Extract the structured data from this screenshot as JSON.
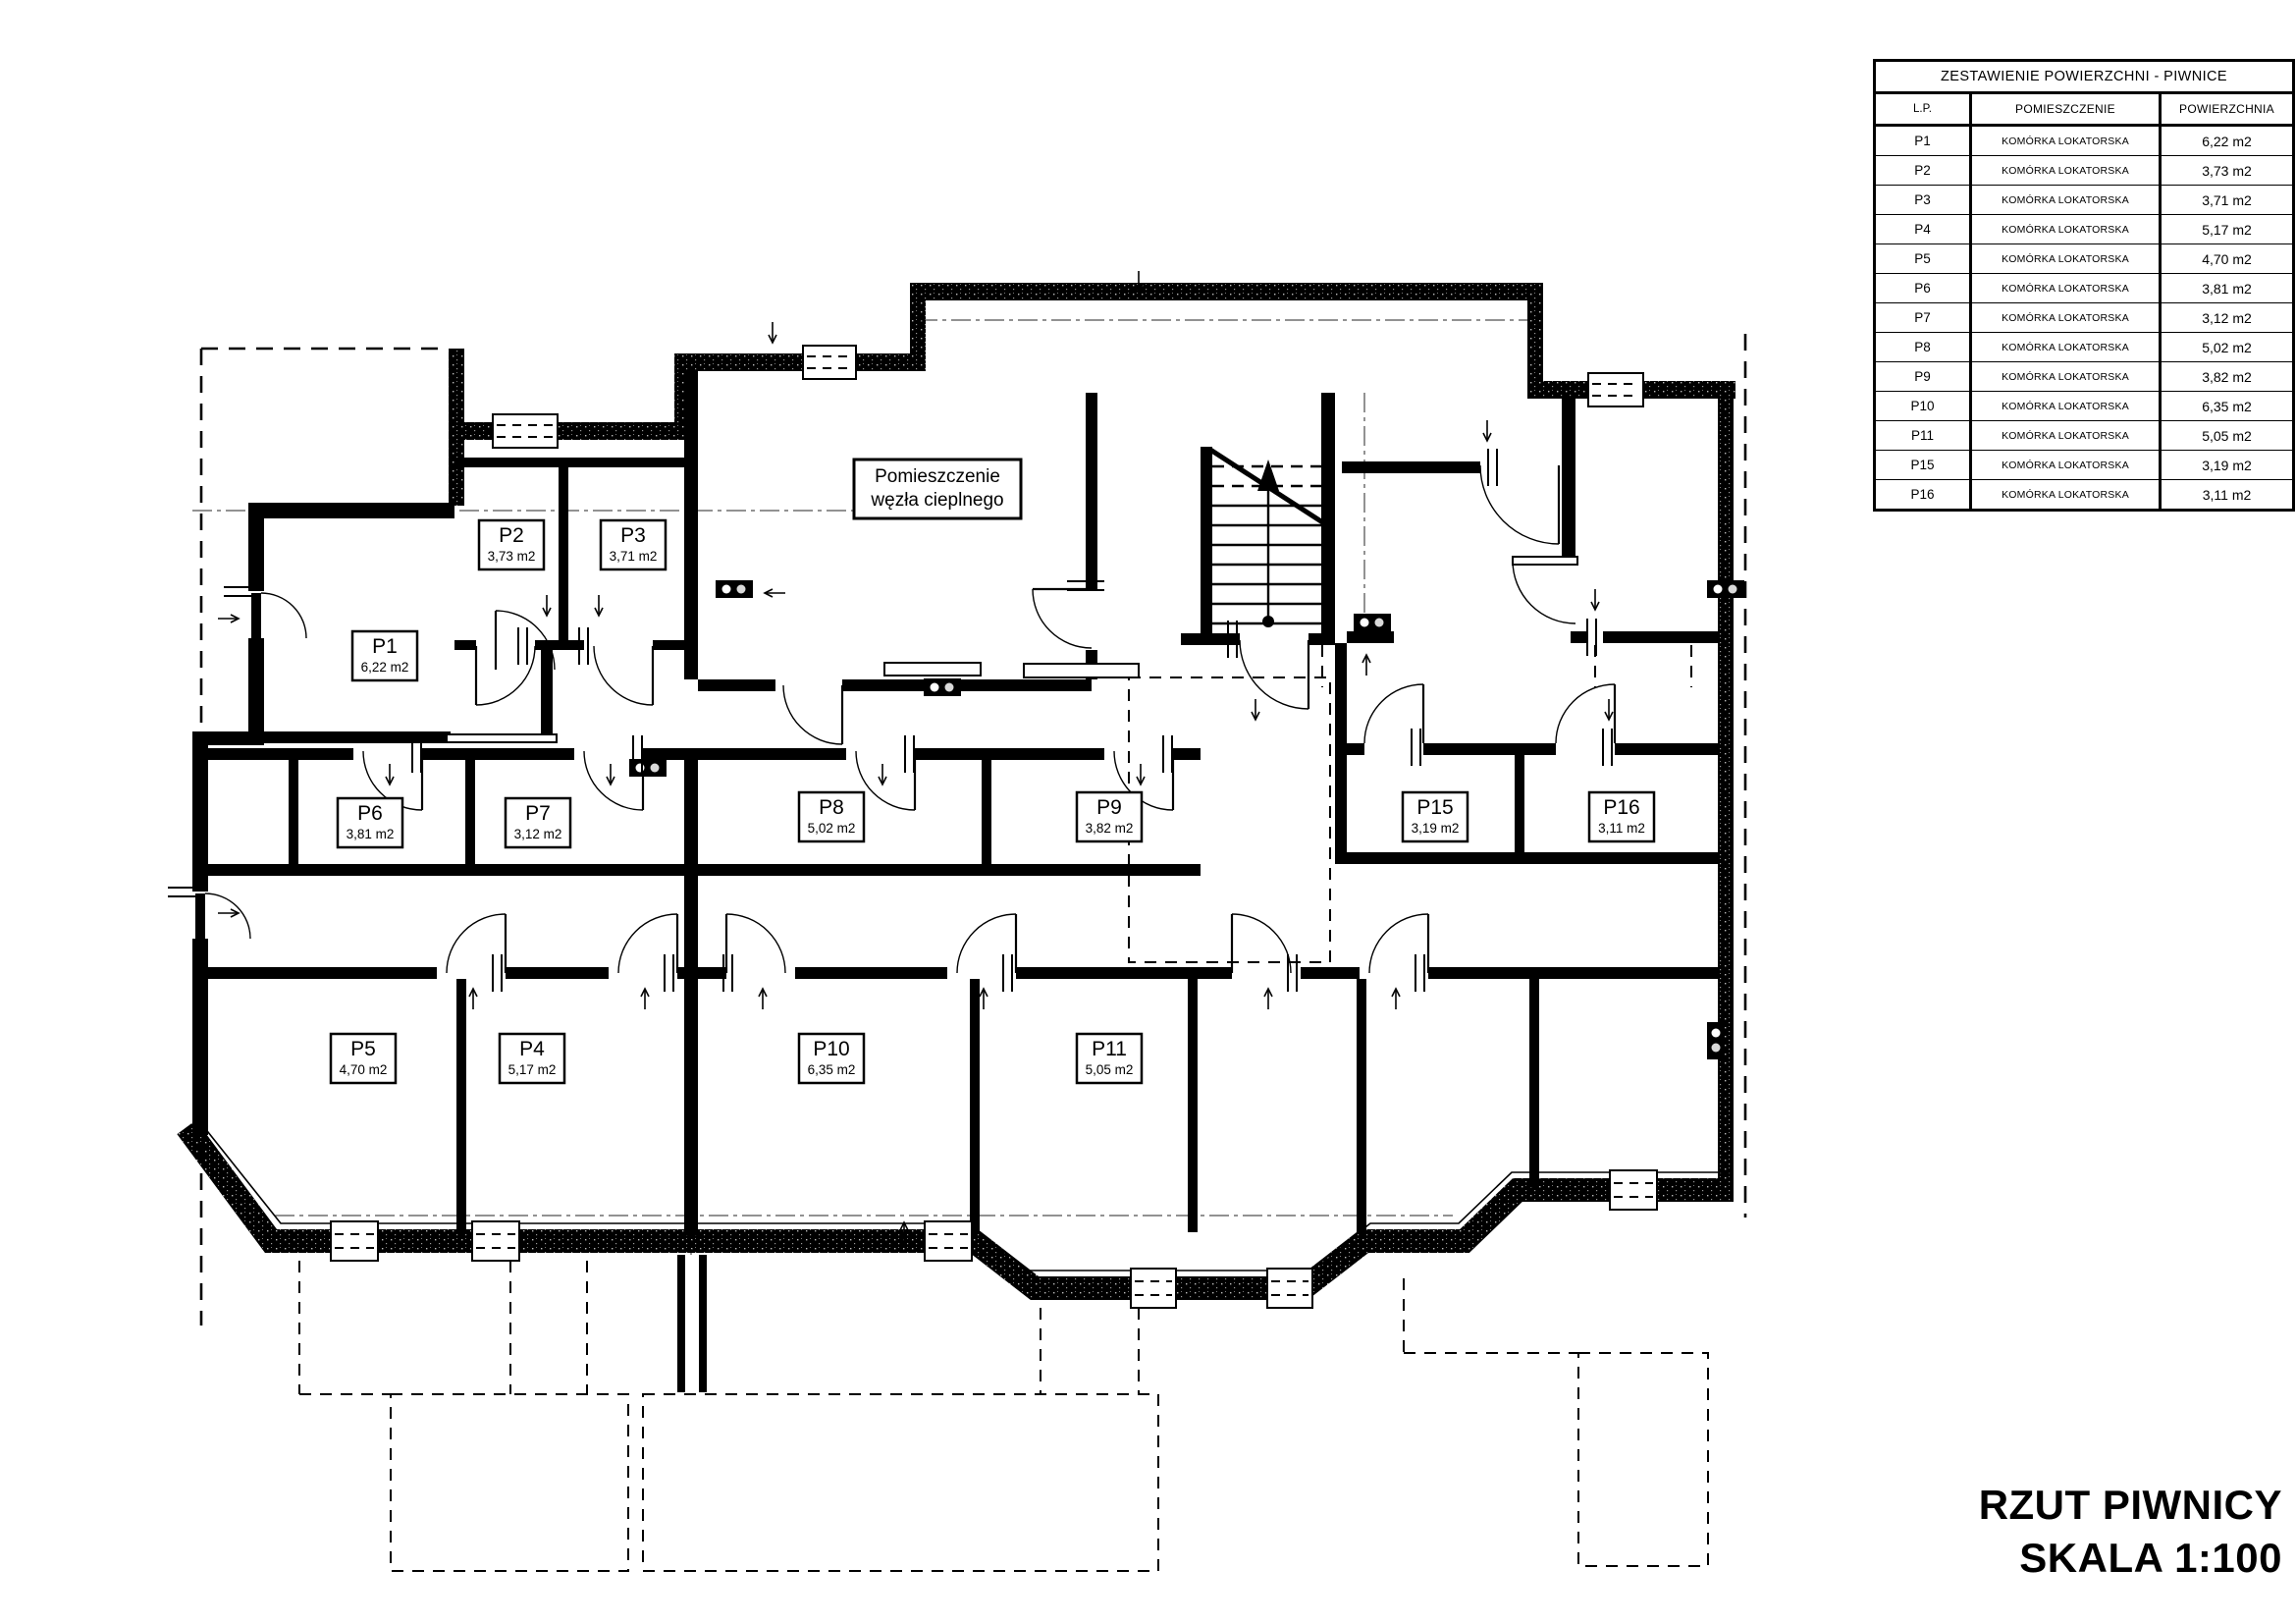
{
  "table": {
    "title": "ZESTAWIENIE POWIERZCHNI - PIWNICE",
    "columns": [
      "L.P.",
      "POMIESZCZENIE",
      "POWIERZCHNIA"
    ],
    "rows": [
      {
        "lp": "P1",
        "room": "KOMÓRKA LOKATORSKA",
        "area": "6,22 m2"
      },
      {
        "lp": "P2",
        "room": "KOMÓRKA LOKATORSKA",
        "area": "3,73 m2"
      },
      {
        "lp": "P3",
        "room": "KOMÓRKA LOKATORSKA",
        "area": "3,71 m2"
      },
      {
        "lp": "P4",
        "room": "KOMÓRKA LOKATORSKA",
        "area": "5,17 m2"
      },
      {
        "lp": "P5",
        "room": "KOMÓRKA LOKATORSKA",
        "area": "4,70 m2"
      },
      {
        "lp": "P6",
        "room": "KOMÓRKA LOKATORSKA",
        "area": "3,81 m2"
      },
      {
        "lp": "P7",
        "room": "KOMÓRKA LOKATORSKA",
        "area": "3,12 m2"
      },
      {
        "lp": "P8",
        "room": "KOMÓRKA LOKATORSKA",
        "area": "5,02 m2"
      },
      {
        "lp": "P9",
        "room": "KOMÓRKA LOKATORSKA",
        "area": "3,82 m2"
      },
      {
        "lp": "P10",
        "room": "KOMÓRKA LOKATORSKA",
        "area": "6,35 m2"
      },
      {
        "lp": "P11",
        "room": "KOMÓRKA LOKATORSKA",
        "area": "5,05 m2"
      },
      {
        "lp": "P15",
        "room": "KOMÓRKA LOKATORSKA",
        "area": "3,19 m2"
      },
      {
        "lp": "P16",
        "room": "KOMÓRKA LOKATORSKA",
        "area": "3,11 m2"
      }
    ]
  },
  "plan": {
    "heating_room": {
      "line1": "Pomieszczenie",
      "line2": "węzła cieplnego"
    },
    "rooms": [
      {
        "id": "P1",
        "area": "6,22 m2"
      },
      {
        "id": "P2",
        "area": "3,73 m2"
      },
      {
        "id": "P3",
        "area": "3,71 m2"
      },
      {
        "id": "P4",
        "area": "5,17 m2"
      },
      {
        "id": "P5",
        "area": "4,70 m2"
      },
      {
        "id": "P6",
        "area": "3,81 m2"
      },
      {
        "id": "P7",
        "area": "3,12 m2"
      },
      {
        "id": "P8",
        "area": "5,02 m2"
      },
      {
        "id": "P9",
        "area": "3,82 m2"
      },
      {
        "id": "P10",
        "area": "6,35 m2"
      },
      {
        "id": "P11",
        "area": "5,05 m2"
      },
      {
        "id": "P15",
        "area": "3,19 m2"
      },
      {
        "id": "P16",
        "area": "3,11 m2"
      }
    ],
    "icons": [
      "door-arc",
      "window-symbol",
      "stairs-up-arrow",
      "vent-arrow",
      "light-fixture"
    ]
  },
  "title_block": {
    "line1": "RZUT PIWNICY",
    "line2": "SKALA 1:100"
  }
}
